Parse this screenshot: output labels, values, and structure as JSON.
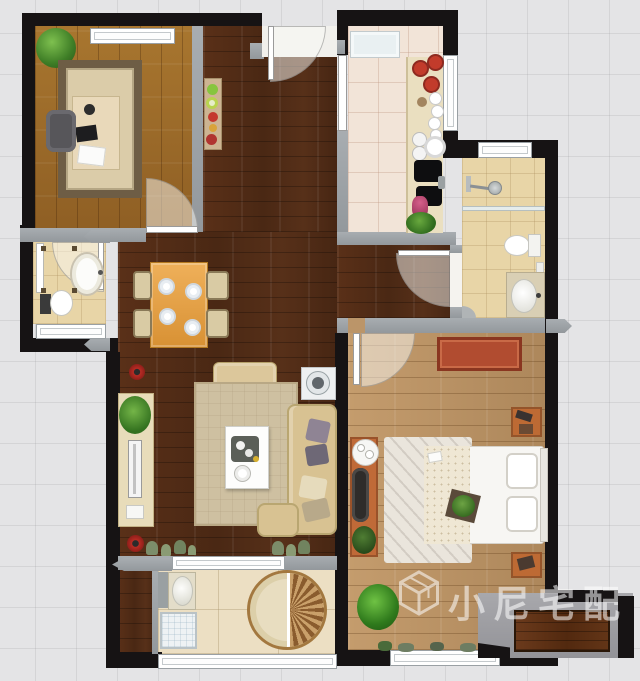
{
  "watermark": {
    "text": "小尼宅配",
    "logo": "isometric-cube-outline",
    "color": "#ffffff",
    "opacity": 0.55
  },
  "floorplan": {
    "type": "apartment-top-down-render",
    "rooms": [
      {
        "id": "study",
        "floor": "golden-wood-planks",
        "furniture": [
          "potted-plant",
          "window",
          "area-rug",
          "desk",
          "laptop",
          "papers",
          "office-chair",
          "swing-door"
        ]
      },
      {
        "id": "entry-hallway",
        "floor": "dark-walnut-planks",
        "furniture": [
          "entry-door",
          "console-shelf",
          "decor-items"
        ]
      },
      {
        "id": "kitchen",
        "floor": "cream-tile",
        "furniture": [
          "refrigerator",
          "counter",
          "red-pots",
          "dishes",
          "sink",
          "cooktop",
          "flowers",
          "plant",
          "sliding-door",
          "window"
        ]
      },
      {
        "id": "main-bathroom",
        "floor": "beige-tile",
        "furniture": [
          "window",
          "shower-head",
          "glass-partition",
          "toilet",
          "vanity-sink",
          "door"
        ]
      },
      {
        "id": "small-bathroom",
        "floor": "beige-tile",
        "furniture": [
          "shower-screen",
          "oval-basin-tub",
          "toilet",
          "window",
          "door"
        ]
      },
      {
        "id": "dining-area",
        "floor": "dark-walnut-planks",
        "furniture": [
          "dining-table",
          "four-plates",
          "four-chairs"
        ]
      },
      {
        "id": "living-room",
        "floor": "dark-walnut-planks",
        "furniture": [
          "armchair-ottoman",
          "side-table-with-fan",
          "tv-cabinet",
          "tv",
          "potted-plant",
          "area-rug",
          "coffee-table",
          "l-shaped-sofa",
          "throw-pillows",
          "corner-flowers",
          "floor-plants",
          "balcony-window"
        ]
      },
      {
        "id": "bedroom",
        "floor": "light-oak-planks",
        "furniture": [
          "swing-door",
          "red-dresser",
          "nightstand-top",
          "nightstand-bottom",
          "double-bed",
          "two-pillows",
          "bed-plant-tray",
          "bedside-rug",
          "vanity-desk",
          "black-chair",
          "tea-table",
          "potted-plants",
          "window",
          "bay-platform"
        ]
      },
      {
        "id": "balcony",
        "floor": "cream-tile",
        "furniture": [
          "laundry-sink",
          "washing-machine",
          "round-fan-rug",
          "window-wall"
        ]
      }
    ],
    "palette": {
      "wall_exterior": "#161314",
      "wall_interior": "#9aa0a5",
      "background_tile": "#e4e4e6",
      "dark_wood_floor": "#53301b",
      "study_wood_floor": "#a0702e",
      "bedroom_wood_floor": "#bb9469",
      "kitchen_tile": "#f2e4d8",
      "bathroom_tile": "#e8d5a7",
      "balcony_tile": "#ecdfc3",
      "sofa_beige": "#d8c292",
      "dining_table_orange": "#e8a348",
      "dresser_red": "#b14c30",
      "nightstand_orange": "#bd6a34",
      "pot_red": "#c23b2b",
      "plant_green": "#3f8c2f"
    }
  }
}
